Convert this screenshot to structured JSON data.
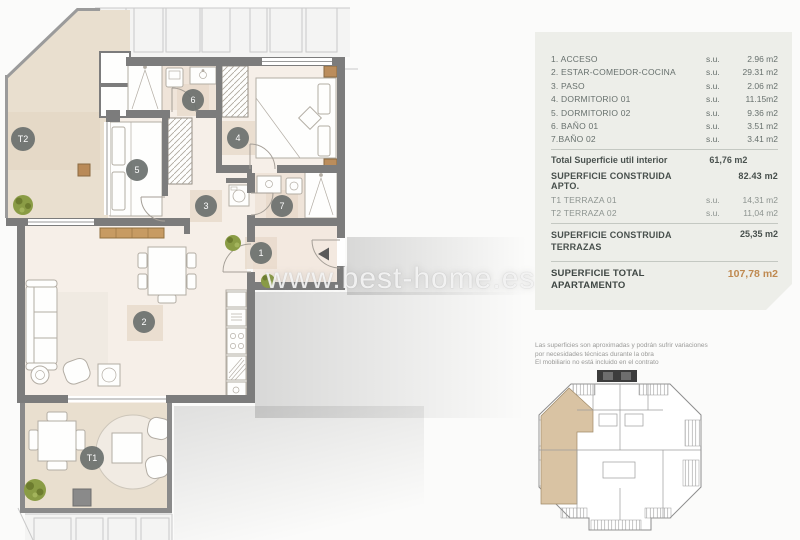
{
  "watermark": "www.best-home.es",
  "plan": {
    "labels": {
      "r1": "1",
      "r2": "2",
      "r3": "3",
      "r4": "4",
      "r5": "5",
      "r6": "6",
      "r7": "7",
      "t1": "T1",
      "t2": "T2"
    }
  },
  "legend": {
    "su_label": "s.u.",
    "rooms": [
      {
        "name": "1. ACCESO",
        "value": "2.96 m2"
      },
      {
        "name": "2. ESTAR-COMEDOR-COCINA",
        "value": "29.31 m2"
      },
      {
        "name": "3. PASO",
        "value": "2.06 m2"
      },
      {
        "name": "4. DORMITORIO 01",
        "value": "11.15m2"
      },
      {
        "name": "5. DORMITORIO 02",
        "value": "9.36 m2"
      },
      {
        "name": "6. BAÑO 01",
        "value": "3.51 m2"
      },
      {
        "name": "7.BAÑO 02",
        "value": "3.41 m2"
      }
    ],
    "total_util": {
      "name": "Total Superficie util interior",
      "value": "61,76 m2"
    },
    "constructed": {
      "name": "SUPERFICIE CONSTRUIDA APTO.",
      "value": "82.43 m2"
    },
    "terraces": [
      {
        "name": "T1 TERRAZA 01",
        "value": "14,31 m2"
      },
      {
        "name": "T2 TERRAZA 02",
        "value": "11,04 m2"
      }
    ],
    "terraces_total": {
      "name": "SUPERFICIE CONSTRUIDA TERRAZAS",
      "value": "25,35 m2"
    },
    "grand_total": {
      "name": "SUPERFICIE TOTAL APARTAMENTO",
      "value": "107,78 m2"
    },
    "accent_color": "#bf8950",
    "panel_color": "#edeee9"
  },
  "disclaimer": [
    "Las superficies son aproximadas y podrán sufrir variaciones",
    "por necesidades técnicas durante la obra",
    "El mobiliario no está incluido en el contrato"
  ]
}
